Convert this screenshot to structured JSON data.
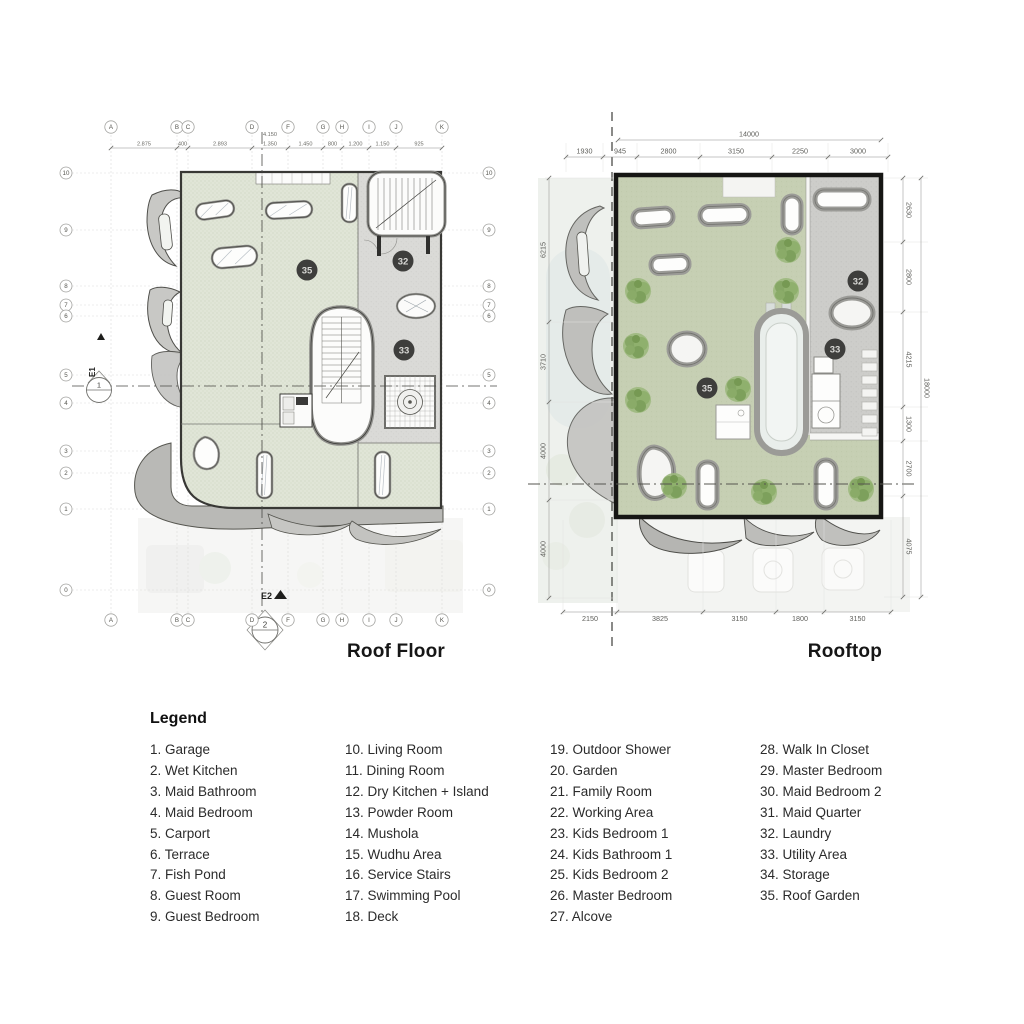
{
  "plans": {
    "roof_floor": {
      "title": "Roof Floor",
      "grid_columns": [
        "A",
        "B",
        "C",
        "D",
        "F",
        "G",
        "H",
        "I",
        "J",
        "K"
      ],
      "grid_rows": [
        "10",
        "9",
        "8",
        "7",
        "6",
        "5",
        "4",
        "3",
        "2",
        "1",
        "0"
      ],
      "top_overall": "4.150",
      "top_dimensions": [
        "2.875",
        "400",
        "2.893",
        "1.350",
        "1.450",
        "800",
        "1.200",
        "1.150",
        "925"
      ],
      "section_markers": [
        "E1",
        "1",
        "E2",
        "2"
      ],
      "room_markers": [
        "35",
        "32",
        "33"
      ]
    },
    "rooftop": {
      "title": "Rooftop",
      "top_overall": "14000",
      "top_dimensions": [
        "1930",
        "945",
        "2800",
        "3150",
        "2250",
        "3000"
      ],
      "left_dimensions": [
        "6215",
        "3710",
        "4000",
        "4000"
      ],
      "right_dimensions": [
        "2630",
        "2800",
        "4215",
        "1300",
        "2700",
        "4075"
      ],
      "right_overall": "18000",
      "bottom_dimensions": [
        "2150",
        "3825",
        "3150",
        "1800",
        "3150"
      ],
      "room_markers": [
        "35",
        "32",
        "33"
      ]
    }
  },
  "legend": {
    "title": "Legend",
    "columns": [
      [
        {
          "num": "1",
          "label": "Garage"
        },
        {
          "num": "2",
          "label": "Wet Kitchen"
        },
        {
          "num": "3",
          "label": "Maid Bathroom"
        },
        {
          "num": "4",
          "label": "Maid Bedroom"
        },
        {
          "num": "5",
          "label": "Carport"
        },
        {
          "num": "6",
          "label": "Terrace"
        },
        {
          "num": "7",
          "label": "Fish Pond"
        },
        {
          "num": "8",
          "label": "Guest Room"
        },
        {
          "num": "9",
          "label": "Guest Bedroom"
        }
      ],
      [
        {
          "num": "10",
          "label": "Living Room"
        },
        {
          "num": "11",
          "label": "Dining Room"
        },
        {
          "num": "12",
          "label": "Dry Kitchen + Island"
        },
        {
          "num": "13",
          "label": "Powder Room"
        },
        {
          "num": "14",
          "label": "Mushola"
        },
        {
          "num": "15",
          "label": "Wudhu Area"
        },
        {
          "num": "16",
          "label": "Service Stairs"
        },
        {
          "num": "17",
          "label": "Swimming Pool"
        },
        {
          "num": "18",
          "label": "Deck"
        }
      ],
      [
        {
          "num": "19",
          "label": "Outdoor Shower"
        },
        {
          "num": "20",
          "label": "Garden"
        },
        {
          "num": "21",
          "label": "Family Room"
        },
        {
          "num": "22",
          "label": "Working Area"
        },
        {
          "num": "23",
          "label": "Kids Bedroom 1"
        },
        {
          "num": "24",
          "label": "Kids Bathroom 1"
        },
        {
          "num": "25",
          "label": "Kids Bedroom 2"
        },
        {
          "num": "26",
          "label": "Master Bedroom"
        },
        {
          "num": "27",
          "label": "Alcove"
        }
      ],
      [
        {
          "num": "28",
          "label": "Walk In Closet"
        },
        {
          "num": "29",
          "label": "Master Bedroom"
        },
        {
          "num": "30",
          "label": "Maid Bedroom 2"
        },
        {
          "num": "31",
          "label": "Maid Quarter"
        },
        {
          "num": "32",
          "label": "Laundry"
        },
        {
          "num": "33",
          "label": "Utility Area"
        },
        {
          "num": "34",
          "label": "Storage"
        },
        {
          "num": "35",
          "label": "Roof Garden"
        }
      ]
    ]
  },
  "colors": {
    "roof_garden_green_left": "#dfe4d6",
    "roof_garden_green_right": "#c6cfb3",
    "service_gray": "#dadad7",
    "band_gray": "#b9b9b6",
    "marker_circle": "#3e3e3c",
    "plan_border_black": "#161614",
    "tree_green": "#8fae6e"
  }
}
